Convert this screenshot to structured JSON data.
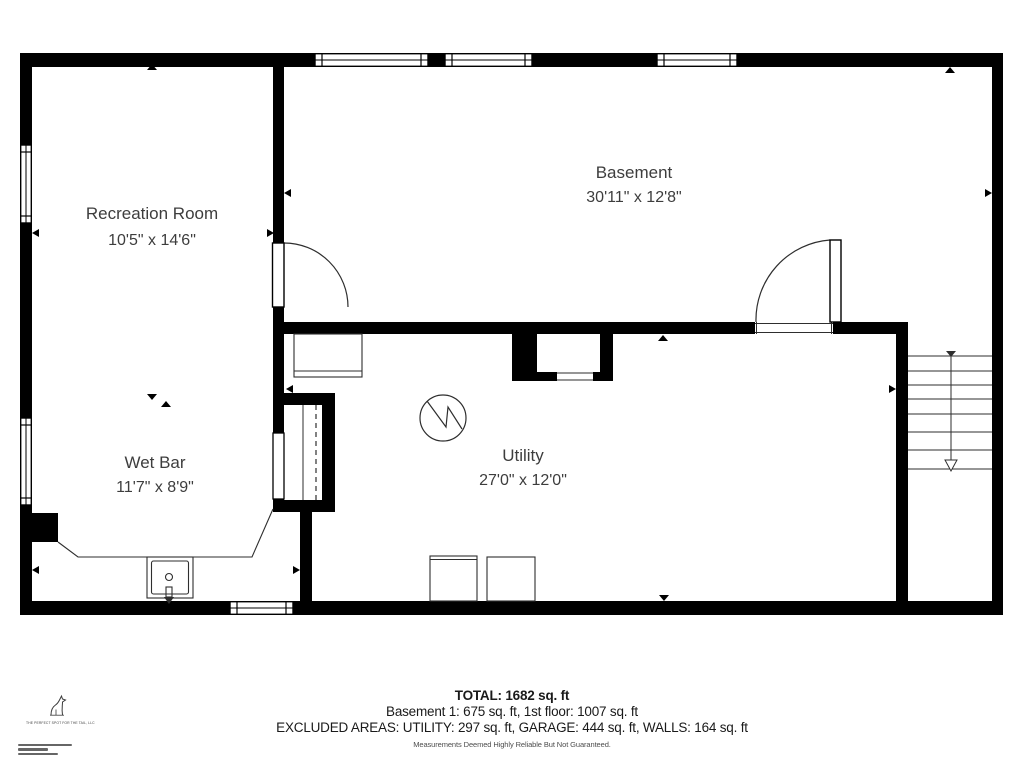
{
  "plan": {
    "title": "Basement floor plan",
    "rooms": [
      {
        "id": "recreation_room",
        "name": "Recreation Room",
        "dims": "10'5\" x 14'6\""
      },
      {
        "id": "basement",
        "name": "Basement",
        "dims": "30'11\" x 12'8\""
      },
      {
        "id": "wet_bar",
        "name": "Wet Bar",
        "dims": "11'7\" x 8'9\""
      },
      {
        "id": "utility",
        "name": "Utility",
        "dims": "27'0\" x 12'0\""
      }
    ],
    "icons": {
      "electrical_panel": "circle-with-zigzag",
      "sink": "rect-with-drain-and-faucet",
      "stairs": "treads-with-down-arrow",
      "doors": "quarter-circle-swing-arcs"
    },
    "colors": {
      "wall": "#000000",
      "line": "#2e2e2e",
      "label_text": "#3d3d3d"
    }
  },
  "footer": {
    "total": "TOTAL: 1682 sq. ft",
    "areas": "Basement 1: 675 sq. ft, 1st floor: 1007 sq. ft",
    "excluded": "EXCLUDED AREAS: UTILITY: 297 sq. ft, GARAGE: 444 sq. ft, WALLS: 164 sq. ft",
    "disclaimer": "Measurements Deemed Highly Reliable But Not Guaranteed."
  },
  "logo": {
    "icon": "dog-silhouette",
    "caption": "THE PERFECT SPOT FOR THE TAIL, LLC"
  }
}
